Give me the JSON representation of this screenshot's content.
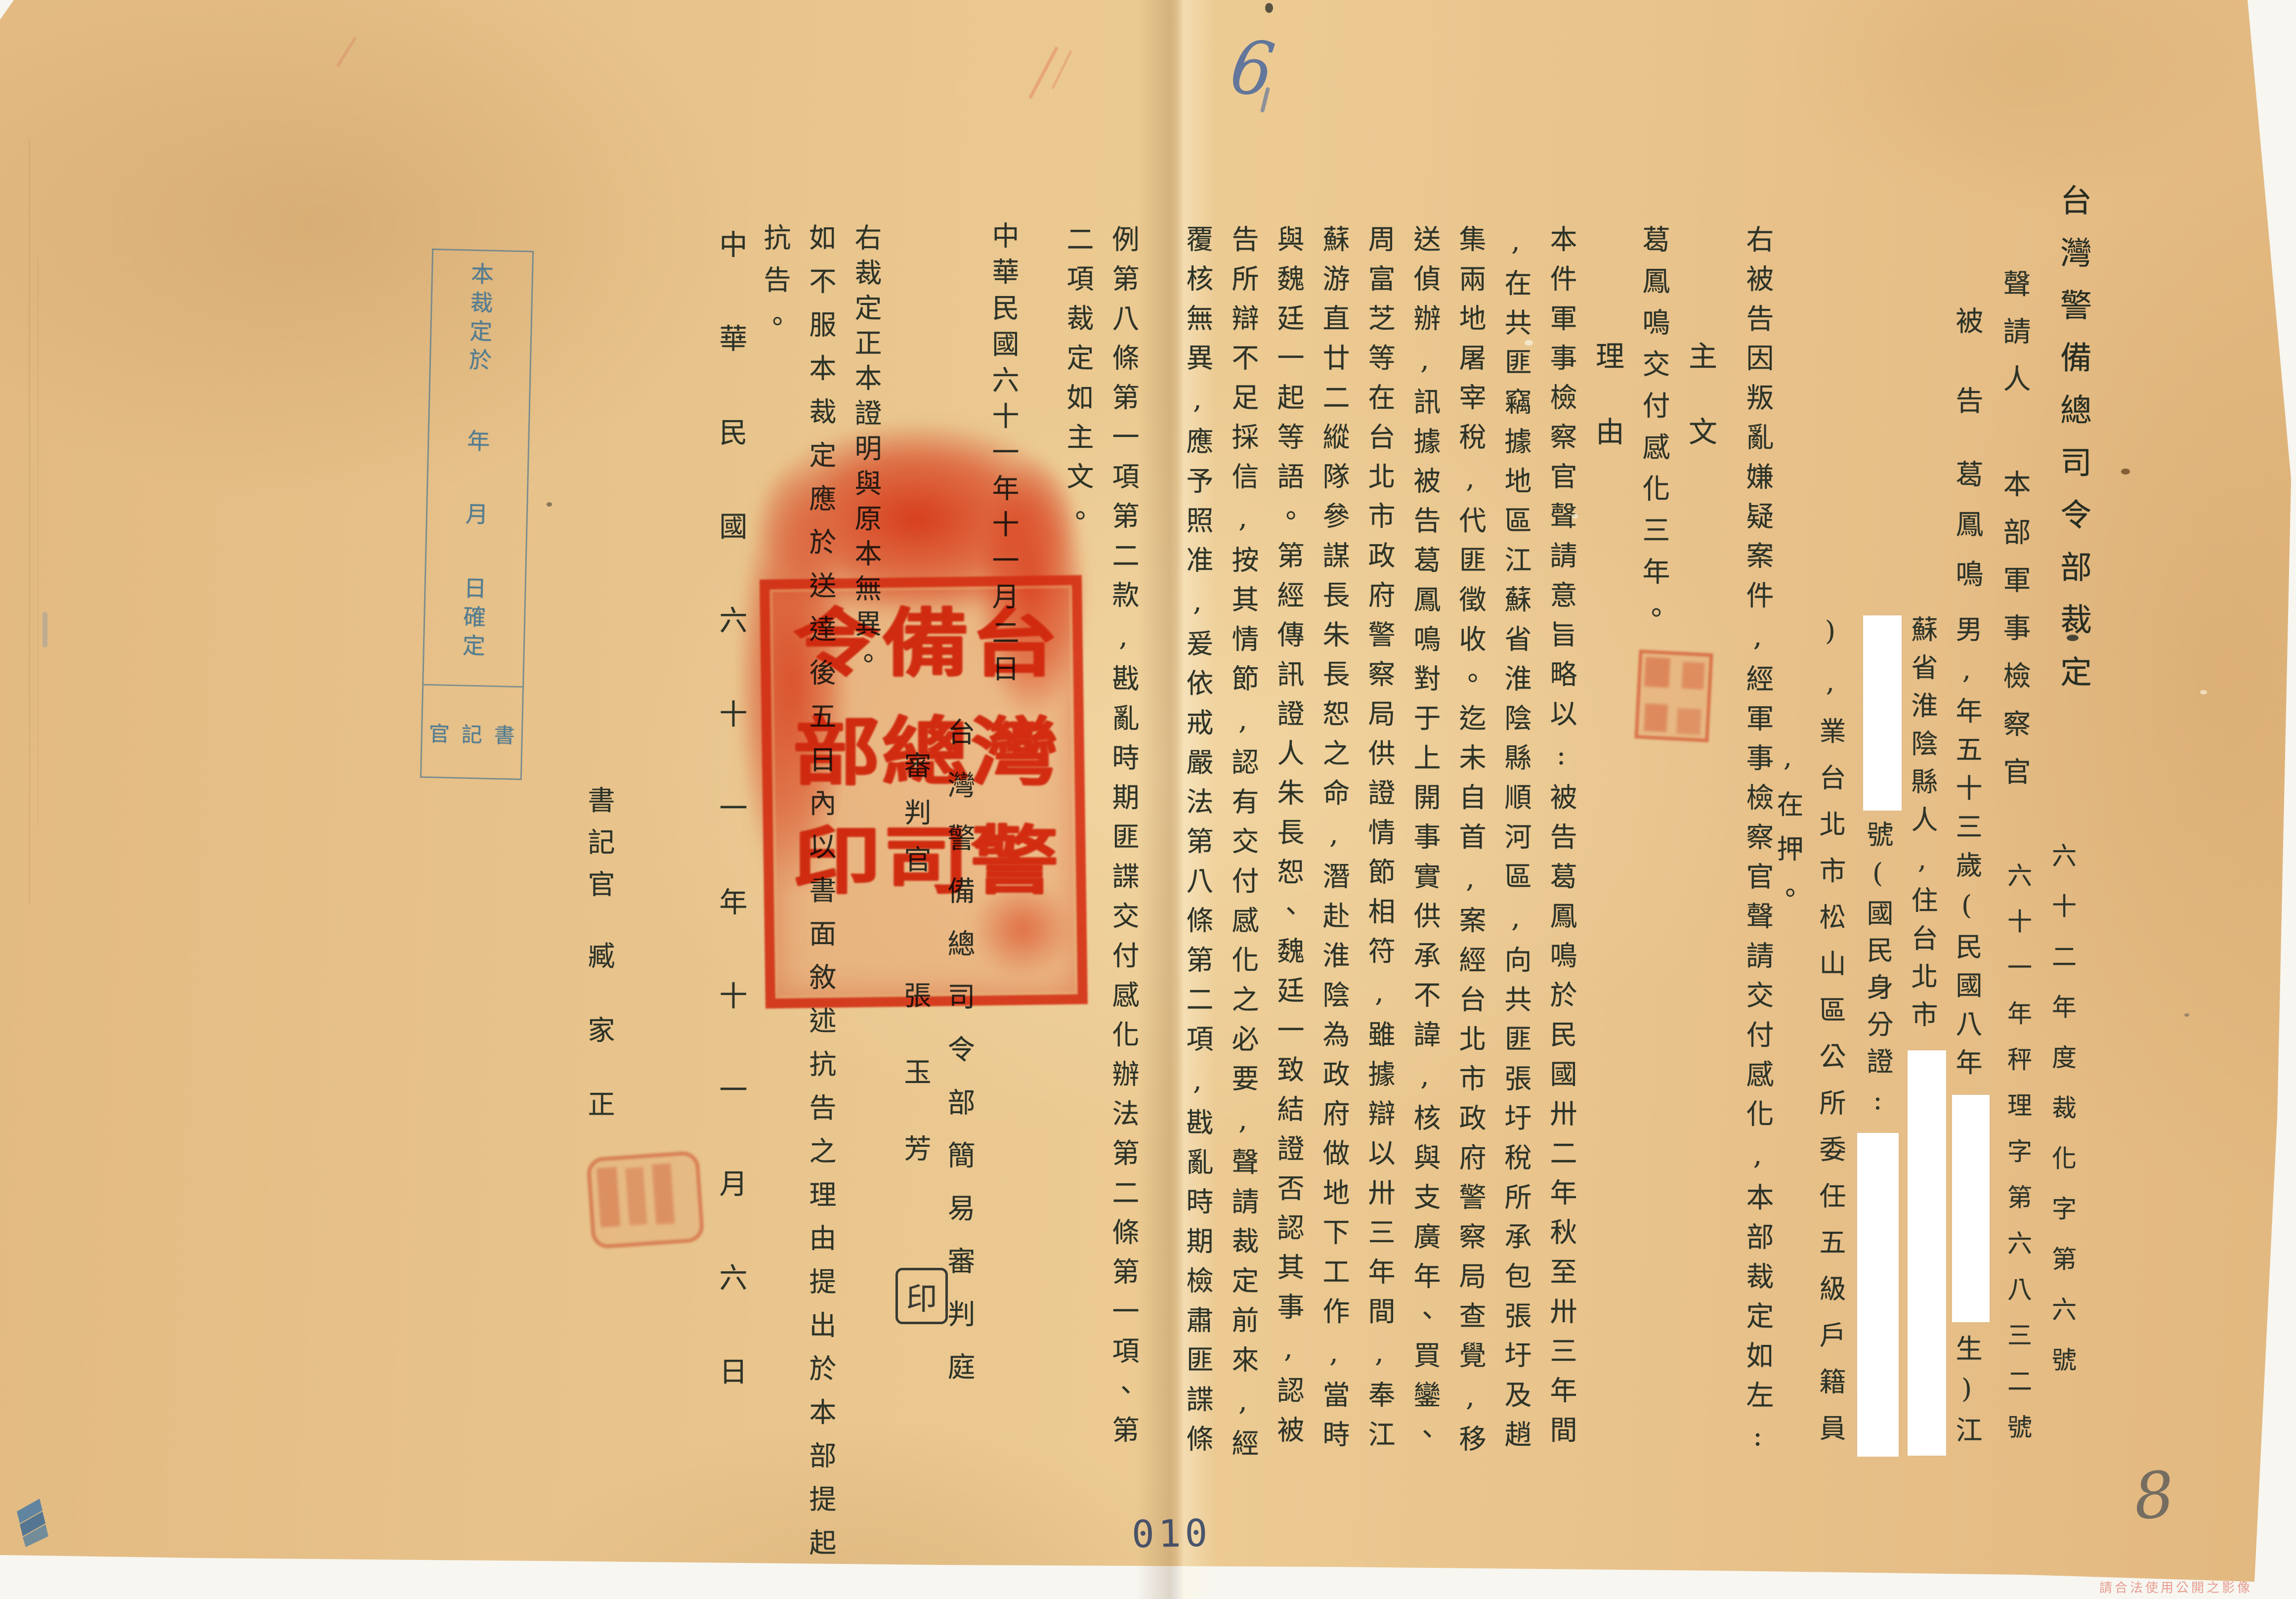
{
  "document": {
    "title": "台灣警備總司令部裁定",
    "case_numbers": [
      "六十二年度裁化字第六號",
      "六十一年秤理字第六八三二號"
    ],
    "parties": {
      "applicant_label": "聲請人",
      "applicant": "本部軍事檢察官",
      "defendant_label": "被告",
      "defendant_name": "葛鳳鳴",
      "info": {
        "colA_pre": "男,年五十三歲(民國八年",
        "colA_post": "生)江",
        "colB": "蘇省淮陰縣人,住台北市",
        "colC": "號(國民身分證:",
        "colD": "),業台北市松山區公所委任五級戶籍員",
        "colE": ",在押。"
      }
    },
    "preamble": "右被告因叛亂嫌疑案件,經軍事檢察官聲請交付感化,本部裁定如左:",
    "main_label": "主文",
    "main_text": "葛鳳鳴交付感化三年。",
    "reason_label": "理由",
    "reason_columns": [
      "本件軍事檢察官聲請意旨略以:被告葛鳳鳴於民國卅二年秋至卅三年間",
      ",在共匪竊據地區江蘇省淮陰縣順河區,向共匪張圩稅所承包張圩及趙",
      "集兩地屠宰稅,代匪徵收。迄未自首,案經台北市政府警察局查覺,移",
      "送偵辦,訊據被告葛鳳鳴對于上開事實供承不諱,核與支廣年、買鑾、",
      "周富芝等在台北市政府警察局供證情節相符,雖據辯以卅三年間,奉江",
      "蘇游直廿二縱隊參謀長朱長恕之命,潛赴淮陰為政府做地下工作,當時",
      "與魏廷一起等語。第經傳訊證人朱長恕、魏廷一致結證否認其事,認被",
      "告所辯不足採信,按其情節,認有交付感化之必要,聲請裁定前來,經",
      "覆核無異,應予照准,爰依戒嚴法第八條第二項,戡亂時期檢肅匪諜條",
      "例第八條第一項第二款,戡亂時期匪諜交付感化辦法第二條第一項、第",
      "二項裁定如主文。"
    ],
    "decision_date": "中華民國六十一年十一月二日",
    "court": "台灣警備總司令部簡易審判庭",
    "judge_title": "審判官",
    "judge_name": "張玉芳",
    "judge_seal_char": "印",
    "certification": "右裁定正本證明與原本無異。",
    "appeal_columns": [
      "如不服本裁定應於送達後五日內以書面敘述抗告之理由提出於本部提起",
      "抗告。"
    ],
    "service_date": "中華民國六十一年十一月六日",
    "clerk_title": "書記官",
    "clerk_name": "臧家正"
  },
  "seal_main": {
    "meaning": "台灣警備總司令部印",
    "columns": [
      "台灣警",
      "備總司",
      "令部印"
    ]
  },
  "confirm_box": {
    "line1": "本裁定於",
    "year_char": "年",
    "month_char": "月",
    "day_line": "日確定",
    "bottom_label": "書記官",
    "bottom_chars": [
      "官",
      "記",
      "書"
    ]
  },
  "annotations": {
    "page_number": "010",
    "handwritten_number": "8",
    "top_mark": "6",
    "watermark_text": "請合法使用公開之影像"
  },
  "colors": {
    "paper": "#e8c48c",
    "ink": "#2d3328",
    "seal_red": "#e4382-e",
    "stamp_blue": "#527b90",
    "page_number_blue": "#2e3f63"
  }
}
